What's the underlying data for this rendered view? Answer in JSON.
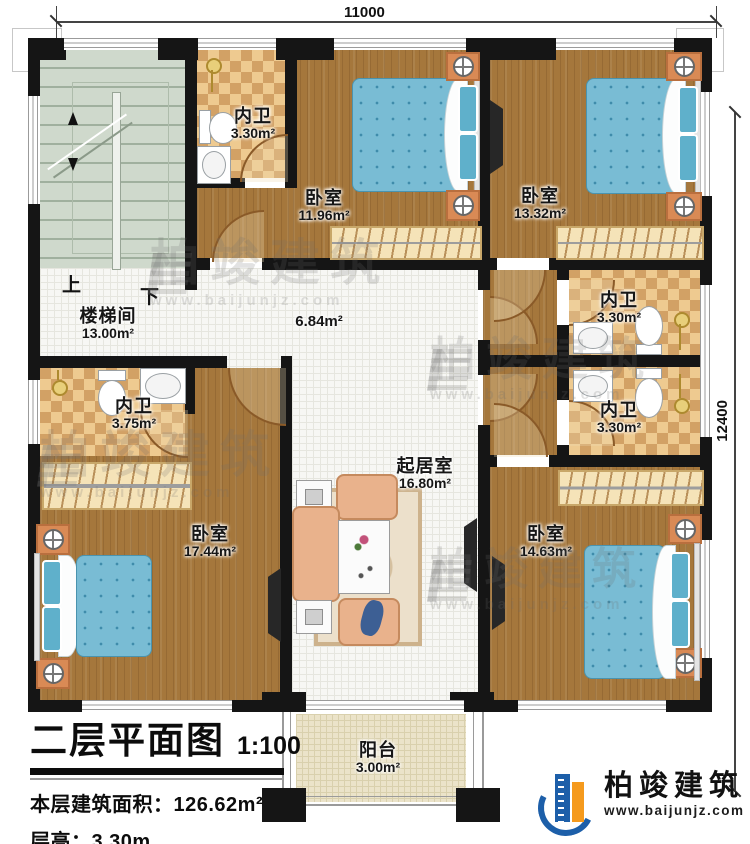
{
  "plan": {
    "dimensions": {
      "top": "11000",
      "right": "12400"
    },
    "stair": {
      "up": "上",
      "down": "下"
    },
    "rooms": {
      "stairwell": {
        "name": "楼梯间",
        "area": "13.00m²"
      },
      "bath_top": {
        "name": "内卫",
        "area": "3.30m²"
      },
      "bed_top_left": {
        "name": "卧室",
        "area": "11.96m²"
      },
      "bed_top_right": {
        "name": "卧室",
        "area": "13.32m²"
      },
      "hallway": {
        "area": "6.84m²"
      },
      "bath_right_upper": {
        "name": "内卫",
        "area": "3.30m²"
      },
      "bath_right_lower": {
        "name": "内卫",
        "area": "3.30m²"
      },
      "bath_left": {
        "name": "内卫",
        "area": "3.75m²"
      },
      "bed_bottom_left": {
        "name": "卧室",
        "area": "17.44m²"
      },
      "living": {
        "name": "起居室",
        "area": "16.80m²"
      },
      "bed_bottom_right": {
        "name": "卧室",
        "area": "14.63m²"
      },
      "balcony": {
        "name": "阳台",
        "area": "3.00m²"
      }
    }
  },
  "titleblock": {
    "title": "二层平面图",
    "scale": "1:100",
    "area_label": "本层建筑面积：",
    "area_value": "126.62m²",
    "height_label": "层高：",
    "height_value": "3.30m"
  },
  "logo": {
    "name": "柏竣建筑",
    "url": "www.baijunjz.com"
  },
  "watermark": {
    "name": "柏竣建筑",
    "url": "www.baijunjz.com"
  }
}
